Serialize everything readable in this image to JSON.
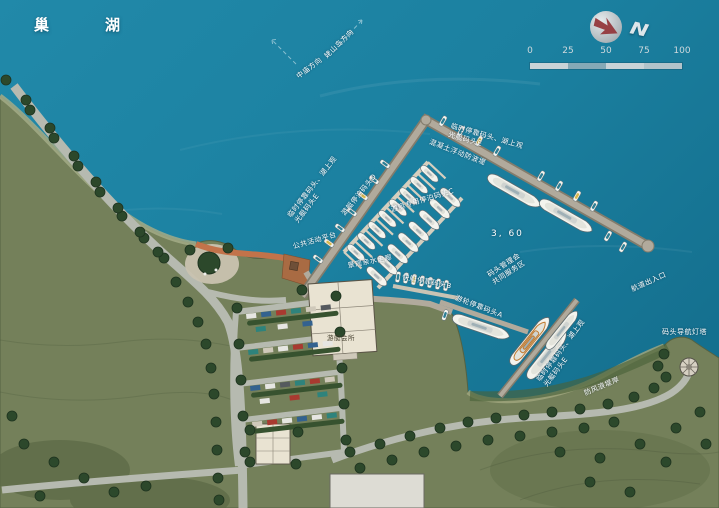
{
  "water": {
    "lake_name": "巢湖"
  },
  "compass": {
    "north": "N"
  },
  "scale": {
    "ticks": [
      "0",
      "25",
      "50",
      "75",
      "100"
    ]
  },
  "directions": {
    "mushan": "姥山岛方向",
    "zhongmiao": "中庙方向"
  },
  "labels": {
    "temp_dock_west": "临时停靠码头、湖上观\n光艇码头E",
    "breakwater": "混凝土浮动防波堤",
    "temp_dock_north": "临时停靠码头、湖上观\n光艇码头E",
    "yacht_berth_d": "游艇停泊码头D",
    "yacht_berth_c": "游艇专用停泊码头C",
    "elevation": "3, 60",
    "management": "码头管理会\n共同服务区",
    "public_platform": "公共活动平台",
    "waterfront_walk": "景观亲水走廊",
    "speedboat_b": "快艇停靠码头B",
    "cruise_a": "游轮停靠码头A",
    "temp_dock_south": "临时停靠码头、湖上观\n光艇码头E",
    "channel_entrance": "航道出入口",
    "lighthouse": "码头导航灯塔",
    "embankment": "防风浪堤岸",
    "clubhouse": "游艇会所"
  },
  "colors": {
    "water": "#1b80a0",
    "water_deep": "#146f8e",
    "land": "#74805a",
    "land_dark": "#5d6a47",
    "road": "#b6bab0",
    "pier": "#b1aa9c",
    "pier_dark": "#837c6c",
    "dock": "#d6cfbf",
    "promenade": "#c2734a",
    "deck": "#a96b43",
    "building": "#e9e3d2",
    "building_line": "#5b5547",
    "tree": "#2c482b",
    "tree_dark": "#1e331f",
    "hedge": "#37522f",
    "boat_white": "#f4f4ee",
    "boat_trim": "#5f6f76",
    "canopy_teal": "#2e7f95",
    "canopy_yellow": "#d8b84a",
    "accent_orange": "#c07a30",
    "text": "#ffffff",
    "text_dark": "#45402f",
    "compass_silver": "#c7cdd1",
    "compass_arrow": "#93383c",
    "scale_light": "#c9d3d7",
    "scale_dark": "#86a9b6"
  }
}
